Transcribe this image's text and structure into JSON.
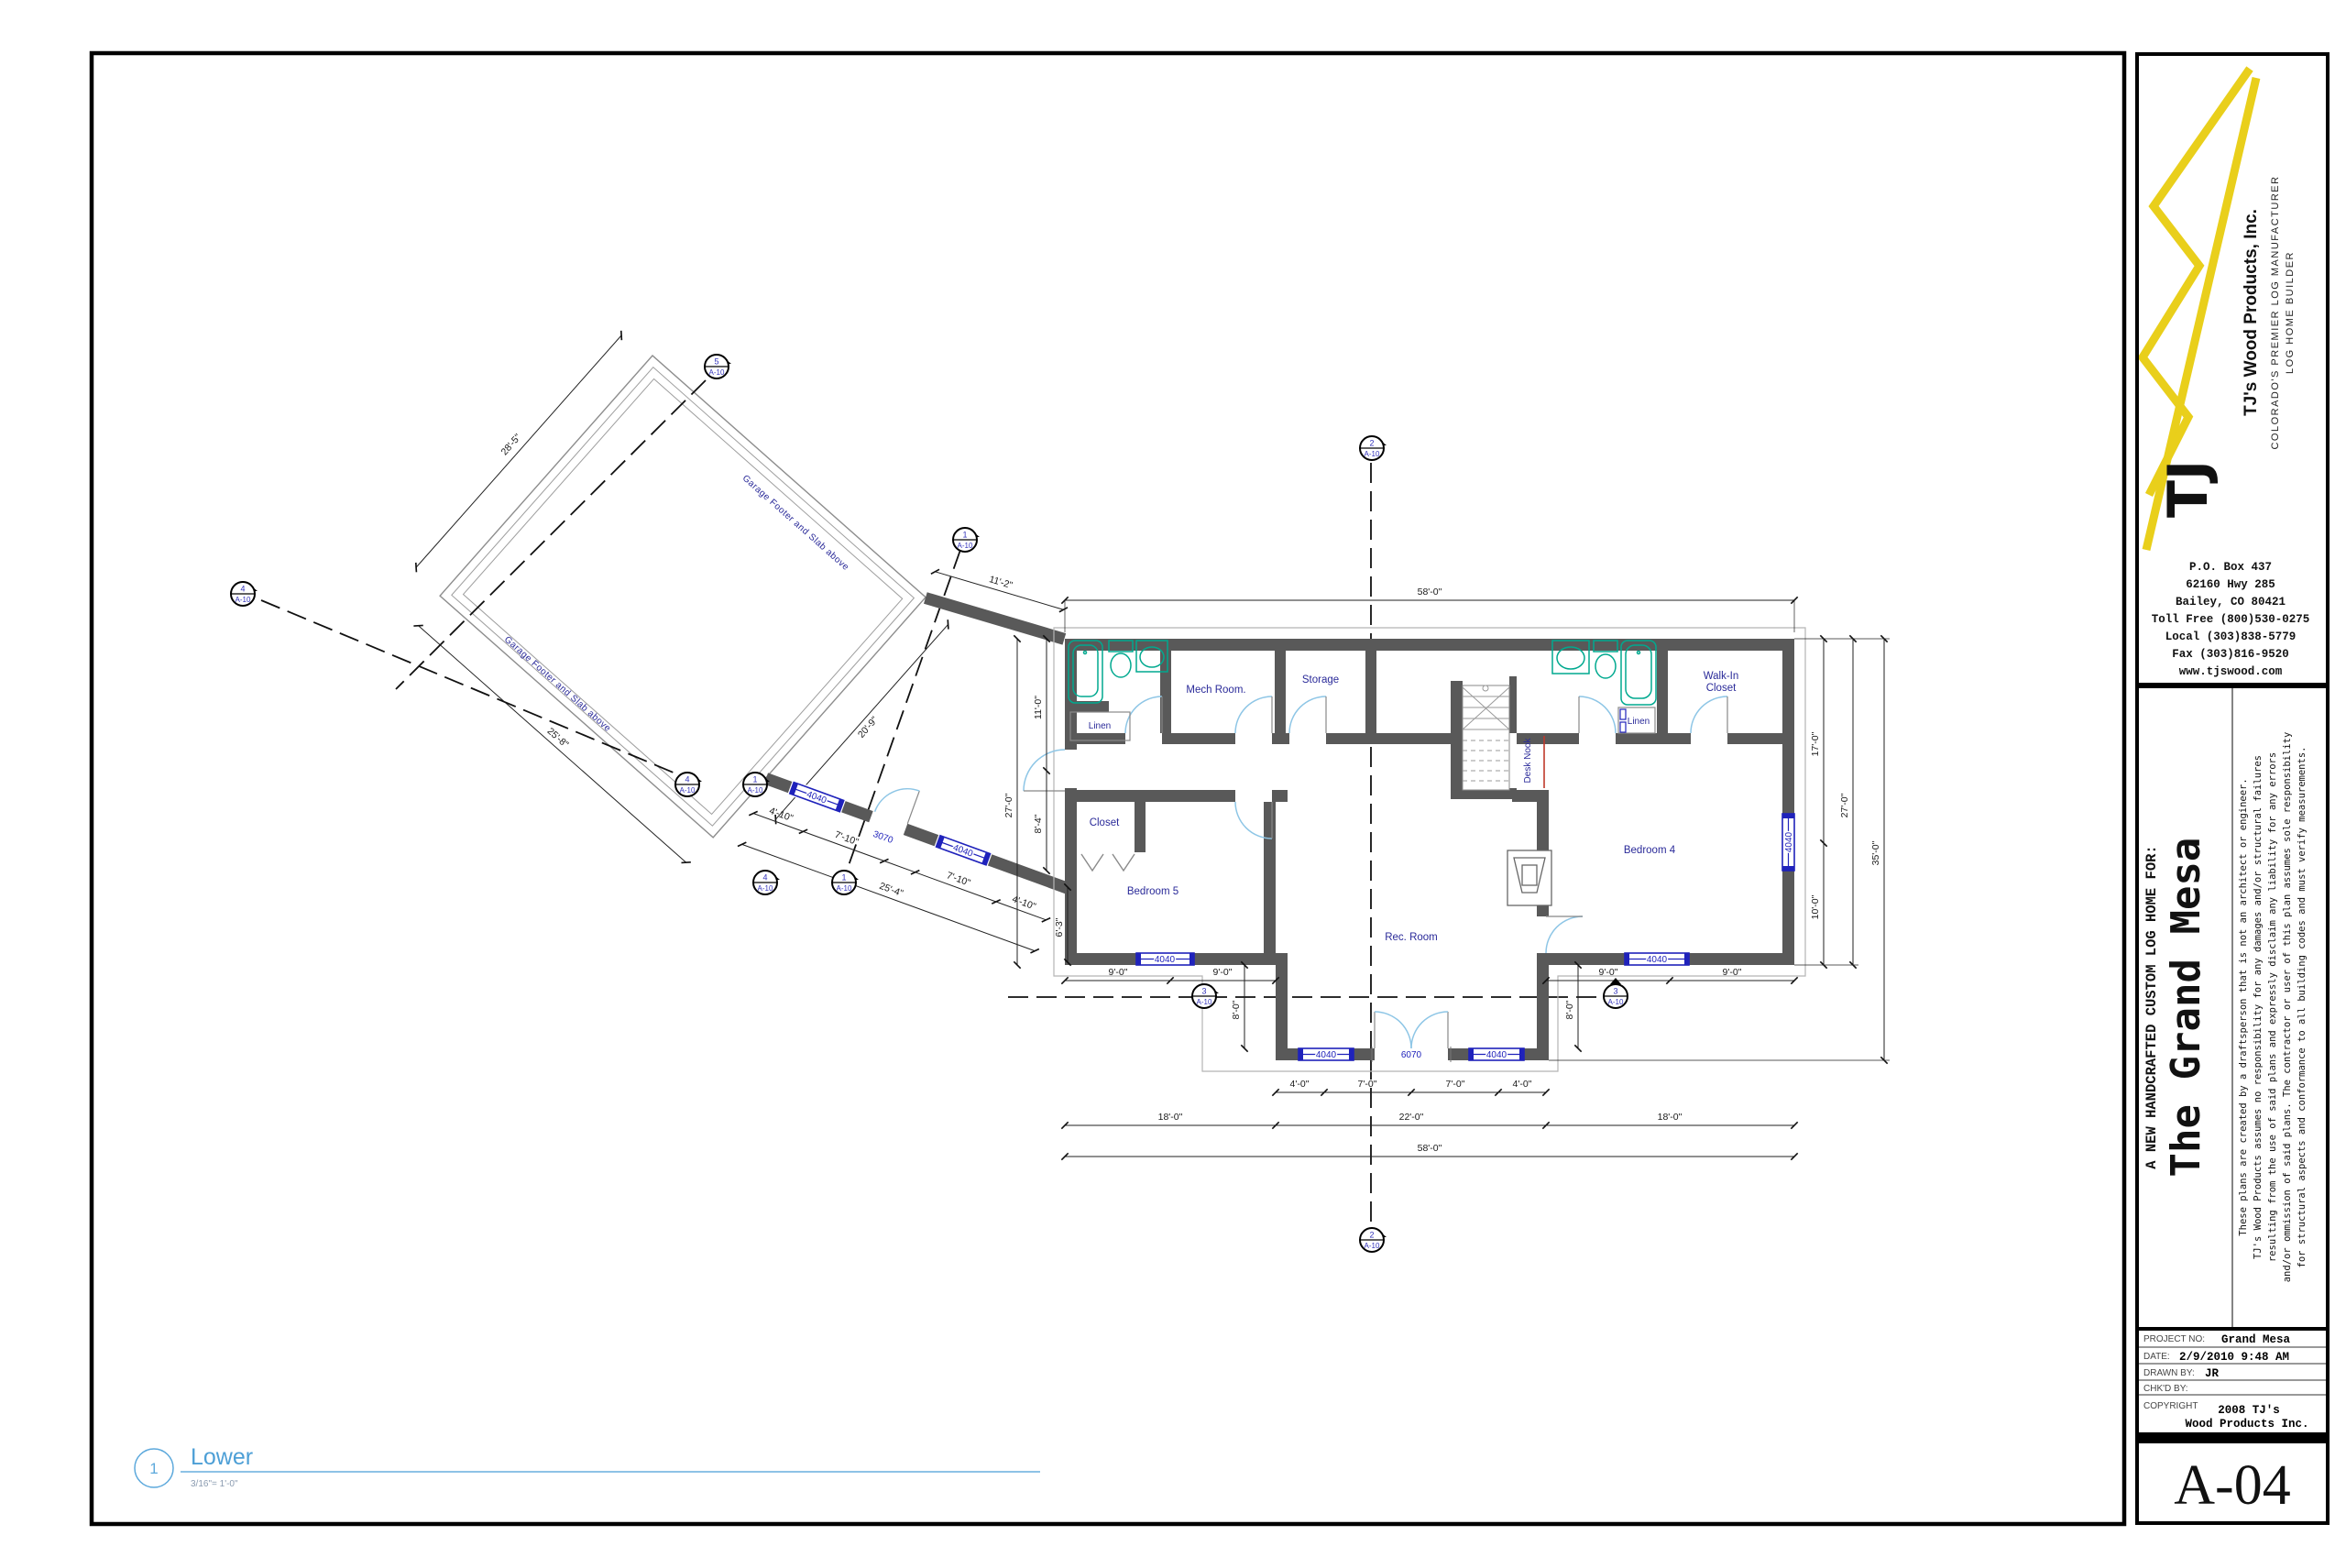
{
  "sheet": {
    "number": "A-04",
    "view": {
      "number": "1",
      "title": "Lower",
      "scale": "3/16\"= 1'-0\""
    }
  },
  "title_block": {
    "company": "TJ's Wood Products, Inc.",
    "monogram": "TJ",
    "tagline1": "COLORADO'S PREMIER LOG MANUFACTURER",
    "tagline2": "LOG HOME BUILDER",
    "address": [
      "P.O. Box 437",
      "62160 Hwy 285",
      "Bailey, CO 80421",
      "Toll Free (800)530-0275",
      "Local (303)838-5779",
      "Fax (303)816-9520",
      "www.tjswood.com"
    ],
    "project_header": "A NEW HANDCRAFTED CUSTOM LOG HOME FOR:",
    "project_name": "The Grand Mesa",
    "disclaimer_lines": [
      "These plans are created by a draftsperson that is not an architect or engineer.",
      "TJ's Wood Products assumes no responsibility for any damages and/or structural failures",
      "resulting from the use of said plans and expressly disclaim any liability for any errors",
      "and/or ommission of said plans.  The contractor or user of this plan assumes sole responsibility",
      "for structural aspects and conformance to all building codes and must verify measurements."
    ],
    "fields": [
      {
        "label": "PROJECT NO:",
        "value": "Grand Mesa"
      },
      {
        "label": "DATE:",
        "value": "2/9/2010 9:48 AM"
      },
      {
        "label": "DRAWN BY:",
        "value": "JR"
      },
      {
        "label": "CHK'D BY:",
        "value": ""
      },
      {
        "label": "COPYRIGHT",
        "value1": "2008 TJ's",
        "value2": "Wood Products Inc."
      }
    ]
  },
  "plan": {
    "rooms": {
      "mech": "Mech Room.",
      "storage": "Storage",
      "wic1": "Walk-In",
      "wic2": "Closet",
      "linen": "Linen",
      "closet": "Closet",
      "bed5": "Bedroom 5",
      "bed4": "Bedroom 4",
      "rec": "Rec. Room",
      "nook": "Desk Nook"
    },
    "openings": {
      "w4040": "4040",
      "w6070": "6070",
      "w3070": "3070"
    },
    "garage_note": "Garage Footer and Slab above",
    "dims": {
      "d58": "58'-0\"",
      "d22": "22'-0\"",
      "d18": "18'-0\"",
      "d9": "9'-0\"",
      "d8": "8'-0\"",
      "d4": "4'-0\"",
      "d7": "7'-0\"",
      "d17": "17'-0\"",
      "d27": "27'-0\"",
      "d10": "10'-0\"",
      "d35": "35'-0\"",
      "d11": "11'-0\"",
      "d8_4": "8'-4\"",
      "d6_3": "6'-3\"",
      "d4_10": "4'-10\"",
      "d7_10": "7'-10\"",
      "d25_4": "25'-4\"",
      "d11_2": "11'-2\"",
      "d20_9": "20'-9\"",
      "d28_5": "28'-5\"",
      "d25_8": "25'-8\""
    },
    "markers": {
      "m1": "1",
      "m2": "2",
      "m3": "3",
      "m4": "4",
      "m5": "5",
      "sheet": "A-10"
    }
  }
}
